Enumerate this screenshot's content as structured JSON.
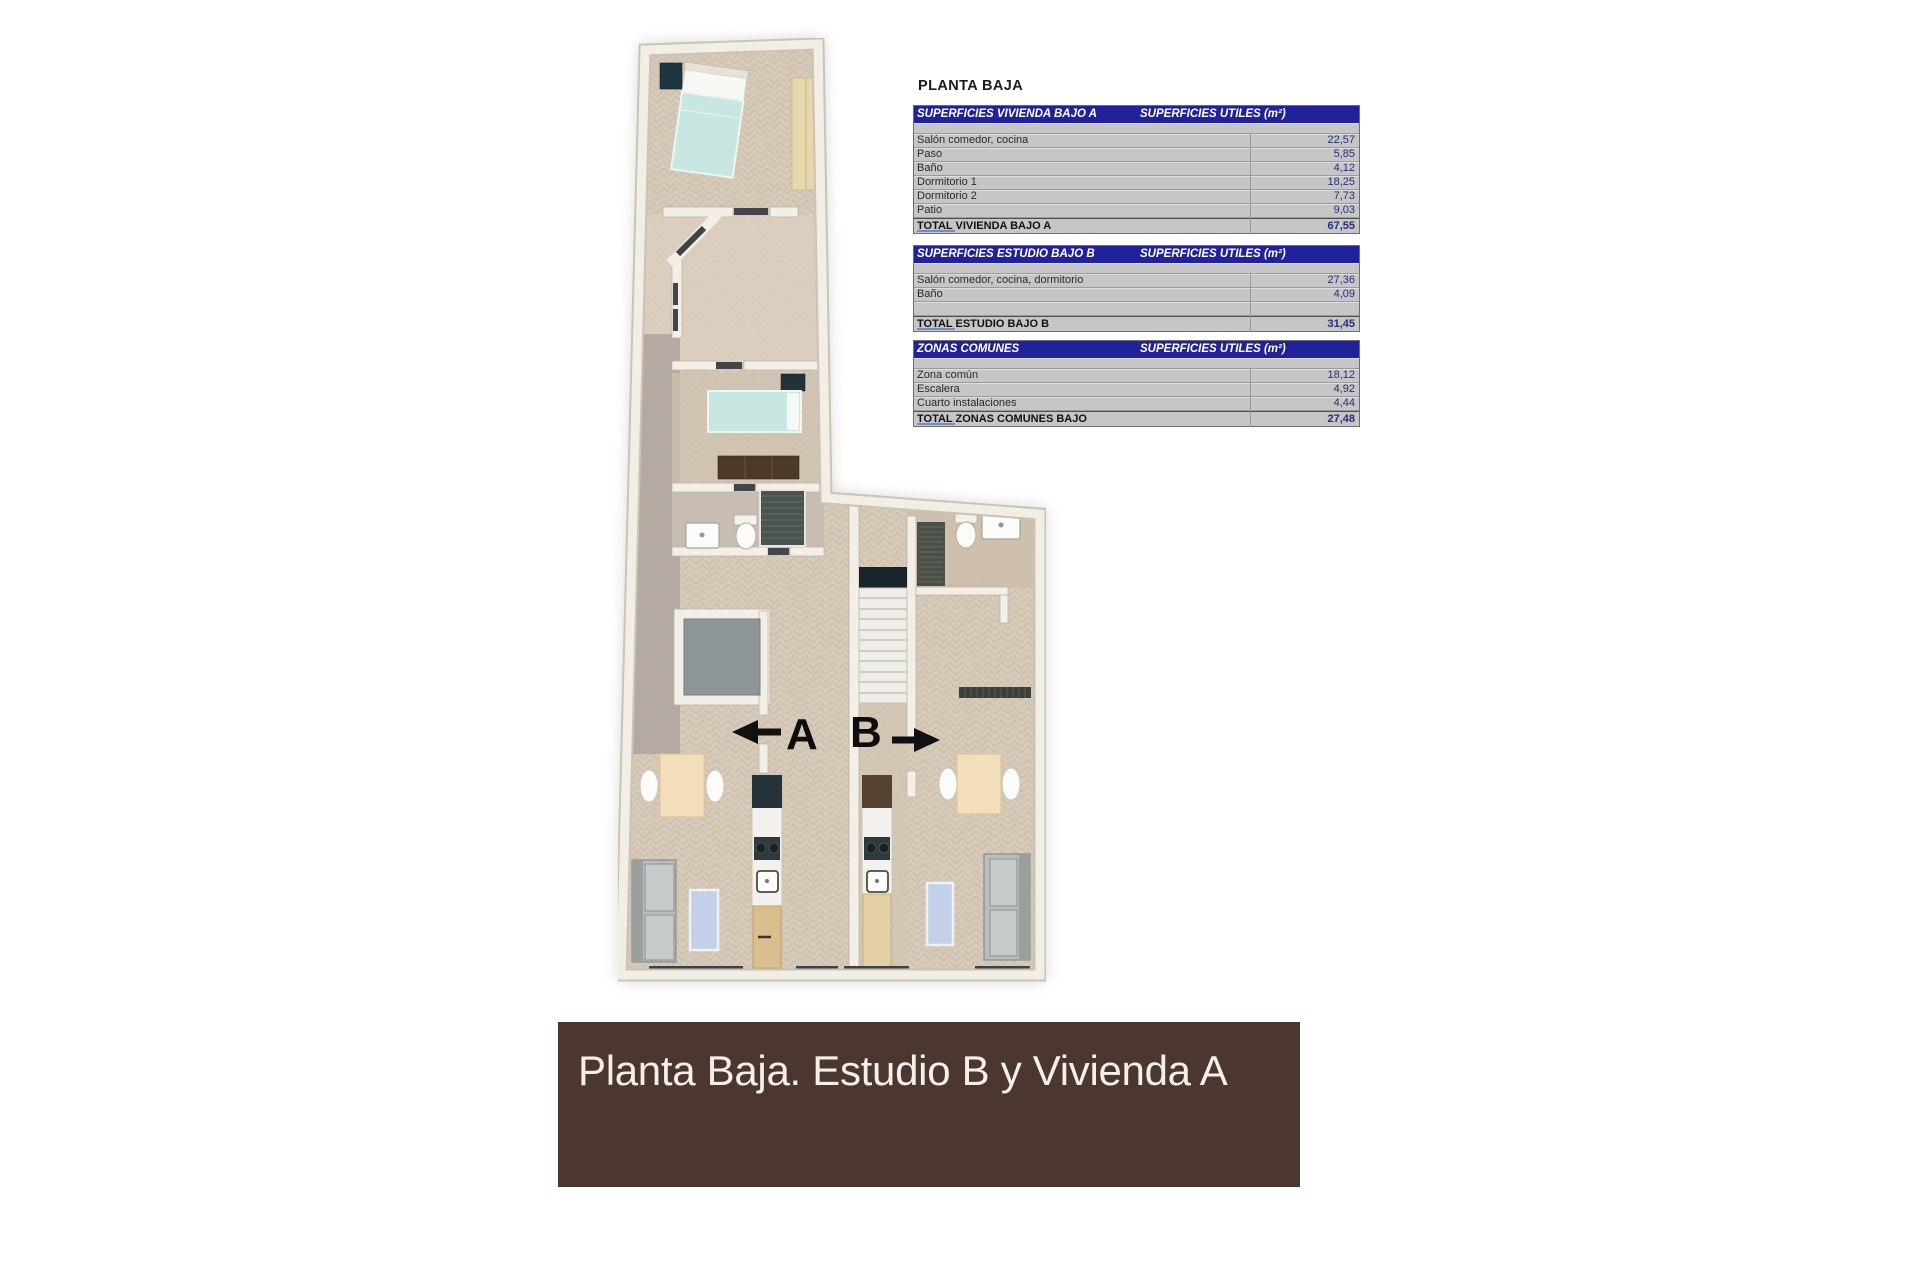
{
  "title": "PLANTA BAJA",
  "tables": [
    {
      "header_left": "SUPERFICIES VIVIENDA BAJO A",
      "header_right": "SUPERFICIES UTILES  (m²)",
      "rows": [
        {
          "label": "Salón comedor, cocina",
          "value": "22,57"
        },
        {
          "label": "Paso",
          "value": "5,85"
        },
        {
          "label": "Baño",
          "value": "4,12"
        },
        {
          "label": "Dormitorio 1",
          "value": "18,25"
        },
        {
          "label": "Dormitorio 2",
          "value": "7,73"
        },
        {
          "label": "Patio",
          "value": "9,03"
        }
      ],
      "total": {
        "label": "TOTAL VIVIENDA BAJO A",
        "value": "67,55"
      }
    },
    {
      "header_left": "SUPERFICIES ESTUDIO BAJO B",
      "header_right": "SUPERFICIES UTILES  (m²)",
      "rows": [
        {
          "label": "Salón comedor, cocina, dormitorio",
          "value": "27,36"
        },
        {
          "label": "Baño",
          "value": "4,09"
        },
        {
          "label": "",
          "value": ""
        }
      ],
      "total": {
        "label": "TOTAL ESTUDIO BAJO B",
        "value": "31,45"
      }
    },
    {
      "header_left": "ZONAS COMUNES",
      "header_right": "SUPERFICIES UTILES  (m²)",
      "rows": [
        {
          "label": "Zona común",
          "value": "18,12"
        },
        {
          "label": "Escalera",
          "value": "4,92"
        },
        {
          "label": "Cuarto instalaciones",
          "value": "4,44"
        }
      ],
      "total": {
        "label": "TOTAL ZONAS COMUNES BAJO",
        "value": "27,48"
      }
    }
  ],
  "floorplan": {
    "unit_a_label": "A",
    "unit_b_label": "B"
  },
  "banner": {
    "text": "Planta Baja. Estudio B y Vivienda A"
  },
  "colors": {
    "table_header_navy": "#21219b",
    "table_row_gray": "#c6c6c6",
    "value_text_navy": "#233077",
    "banner_brown": "#4c3730",
    "floor_beige": "#d7cab9",
    "corridor_gray": "#b2a8a2",
    "bed_teal": "#c8e7e2",
    "furniture_dark": "#26343a"
  }
}
